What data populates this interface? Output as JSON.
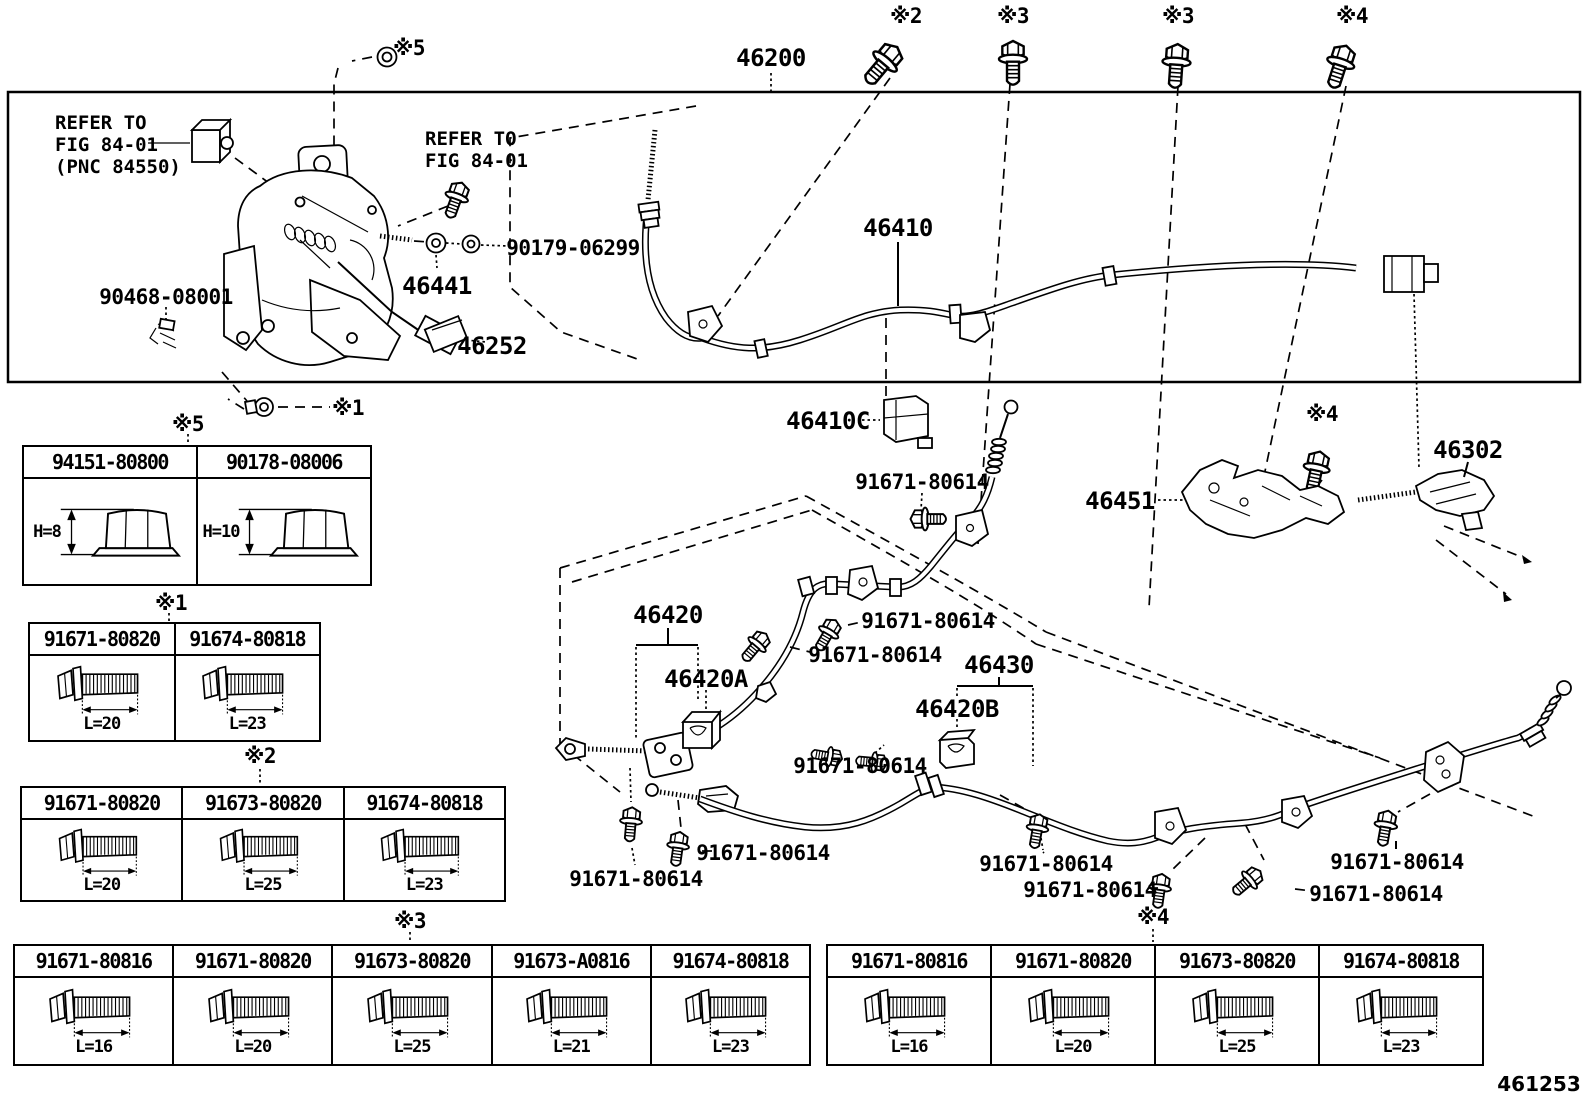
{
  "figure_number": "461253",
  "colors": {
    "ink": "#000000",
    "paper": "#ffffff"
  },
  "notes": {
    "refer1": "REFER TO\nFIG 84-01\n(PNC 84550)",
    "refer2": "REFER TO\nFIG 84-01"
  },
  "labels": [
    {
      "text": "※5"
    },
    {
      "text": "46200"
    },
    {
      "text": "※2"
    },
    {
      "text": "※3"
    },
    {
      "text": "※3"
    },
    {
      "text": "※4"
    },
    {
      "text": "90179-06299"
    },
    {
      "text": "46441"
    },
    {
      "text": "90468-08001"
    },
    {
      "text": "46252"
    },
    {
      "text": "※1"
    },
    {
      "text": "46410"
    },
    {
      "text": "46410C"
    },
    {
      "text": "91671-80614"
    },
    {
      "text": "46451"
    },
    {
      "text": "※4"
    },
    {
      "text": "46302"
    },
    {
      "text": "46420"
    },
    {
      "text": "46420A"
    },
    {
      "text": "91671-80614"
    },
    {
      "text": "91671-80614"
    },
    {
      "text": "46430"
    },
    {
      "text": "46420B"
    },
    {
      "text": "91671-80614"
    },
    {
      "text": "91671-80614"
    },
    {
      "text": "91671-80614"
    },
    {
      "text": "91671-80614"
    },
    {
      "text": "91671-80614"
    },
    {
      "text": "91671-80614"
    },
    {
      "text": "91671-80614"
    }
  ],
  "tables": {
    "t5": {
      "marker": "※5",
      "columns": [
        {
          "part": "94151-80800",
          "dim": "H=8"
        },
        {
          "part": "90178-08006",
          "dim": "H=10"
        }
      ]
    },
    "t1": {
      "marker": "※1",
      "columns": [
        {
          "part": "91671-80820",
          "dim": "L=20"
        },
        {
          "part": "91674-80818",
          "dim": "L=23"
        }
      ]
    },
    "t2": {
      "marker": "※2",
      "columns": [
        {
          "part": "91671-80820",
          "dim": "L=20"
        },
        {
          "part": "91673-80820",
          "dim": "L=25"
        },
        {
          "part": "91674-80818",
          "dim": "L=23"
        }
      ]
    },
    "t3": {
      "marker": "※3",
      "columns": [
        {
          "part": "91671-80816",
          "dim": "L=16"
        },
        {
          "part": "91671-80820",
          "dim": "L=20"
        },
        {
          "part": "91673-80820",
          "dim": "L=25"
        },
        {
          "part": "91673-A0816",
          "dim": "L=21"
        },
        {
          "part": "91674-80818",
          "dim": "L=23"
        }
      ]
    },
    "t4": {
      "marker": "※4",
      "columns": [
        {
          "part": "91671-80816",
          "dim": "L=16"
        },
        {
          "part": "91671-80820",
          "dim": "L=20"
        },
        {
          "part": "91673-80820",
          "dim": "L=25"
        },
        {
          "part": "91674-80818",
          "dim": "L=23"
        }
      ]
    }
  }
}
